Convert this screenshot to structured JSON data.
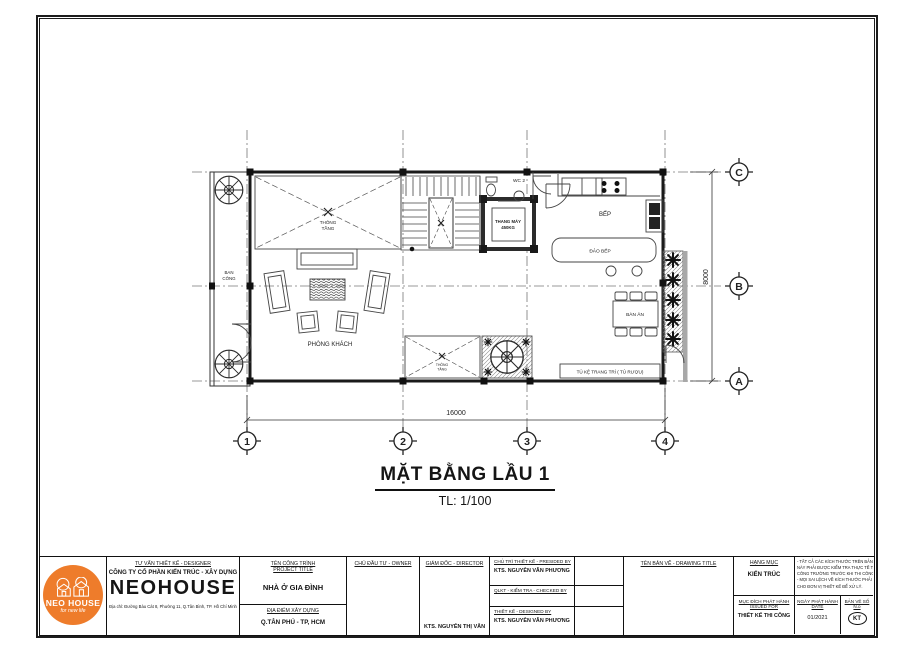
{
  "plan": {
    "title": "MẶT BẰNG LẦU 1",
    "scale": "TL: 1/100",
    "grid": {
      "c1": "1",
      "c2": "2",
      "c3": "3",
      "c4": "4",
      "rA": "A",
      "rB": "B",
      "rC": "C"
    },
    "dims": {
      "width": "16000",
      "height": "8000"
    },
    "rooms": {
      "balcony1": "BAN",
      "balcony2": "CÔNG",
      "void1a": "THÔNG",
      "void1b": "TẦNG",
      "wc": "WC 2",
      "elev1": "THANG MÁY",
      "elev2": "450KG",
      "kitchen": "BẾP",
      "island": "ĐẢO BẾP",
      "dining": "BÀN ĂN",
      "shelf": "TỦ KỆ TRANG TRÍ ( TỦ RƯỢU)",
      "living": "PHÒNG KHÁCH",
      "void2a": "THÔNG",
      "void2b": "TẦNG"
    }
  },
  "titleblock": {
    "designer_heading": "TƯ VẤN THIẾT KẾ - DESIGNER",
    "company_line": "CÔNG TY CỔ PHẦN KIẾN TRÚC - XÂY DỰNG",
    "company_name": "NEOHOUSE",
    "address": "Địa chỉ: Đường Bàu Cát 8, Phường 11, Q.Tân Bình, TP. Hồ Chí Minh",
    "logo": {
      "name": "NEO HOUSE",
      "tagline": "for new life"
    },
    "project_heading_1": "TÊN CÔNG TRÌNH",
    "project_heading_2": "PROJECT TITLE",
    "project_name": "NHÀ Ở GIA ĐÌNH",
    "location_heading": "ĐỊA ĐIỂM XÂY DỰNG",
    "location": "Q.TÂN PHÚ - TP, HCM",
    "owner_heading": "CHỦ ĐẦU TƯ - OWNER",
    "director_heading": "GIÁM ĐỐC - DIRECTOR",
    "director_name": "KTS. NGUYỄN THỊ VÂN",
    "presided_heading": "CHỦ TRÌ THIẾT KẾ - PRESIDED BY",
    "presided_name": "KTS. NGUYỄN VĂN PHƯƠNG",
    "checked_heading": "QLKT - KIỂM TRA - CHECKED BY",
    "designed_heading": "THIẾT KẾ - DESIGNED BY",
    "designed_name": "KTS. NGUYỄN VĂN PHƯƠNG",
    "drawing_title_heading": "TÊN BẢN VẼ - DRAWING TITLE",
    "category_heading": "HẠNG MỤC",
    "category": "KIẾN TRÚC",
    "notes": [
      "- TẤT CẢ CÁC KÍCH THƯỚC TRÊN BẢN VẼ",
      "NÀY PHẢI ĐƯỢC KIỂM TRA THỰC TẾ THI",
      "CÔNG TRƯỜNG TRƯỚC KHI THI CÔNG,",
      "- MỌI SAI LỆCH VỀ KÍCH THƯỚC PHẢI BÁO",
      "CHO ĐƠN VỊ THIẾT KẾ ĐỂ XỬ LÝ."
    ],
    "issued_heading_1": "MỤC ĐÍCH PHÁT HÀNH",
    "issued_heading_2": "ISSUED FOR",
    "issued_for": "THIẾT KẾ THI CÔNG",
    "date_heading_1": "NGÀY PHÁT HÀNH",
    "date_heading_2": "DATE",
    "date_value": "01/2021",
    "number_heading_1": "BẢN VẼ SỐ",
    "number_heading_2": "N.o",
    "number_value": "KT"
  },
  "colors": {
    "brand_orange": "#EE7C2B",
    "line": "#1c1c1c"
  }
}
